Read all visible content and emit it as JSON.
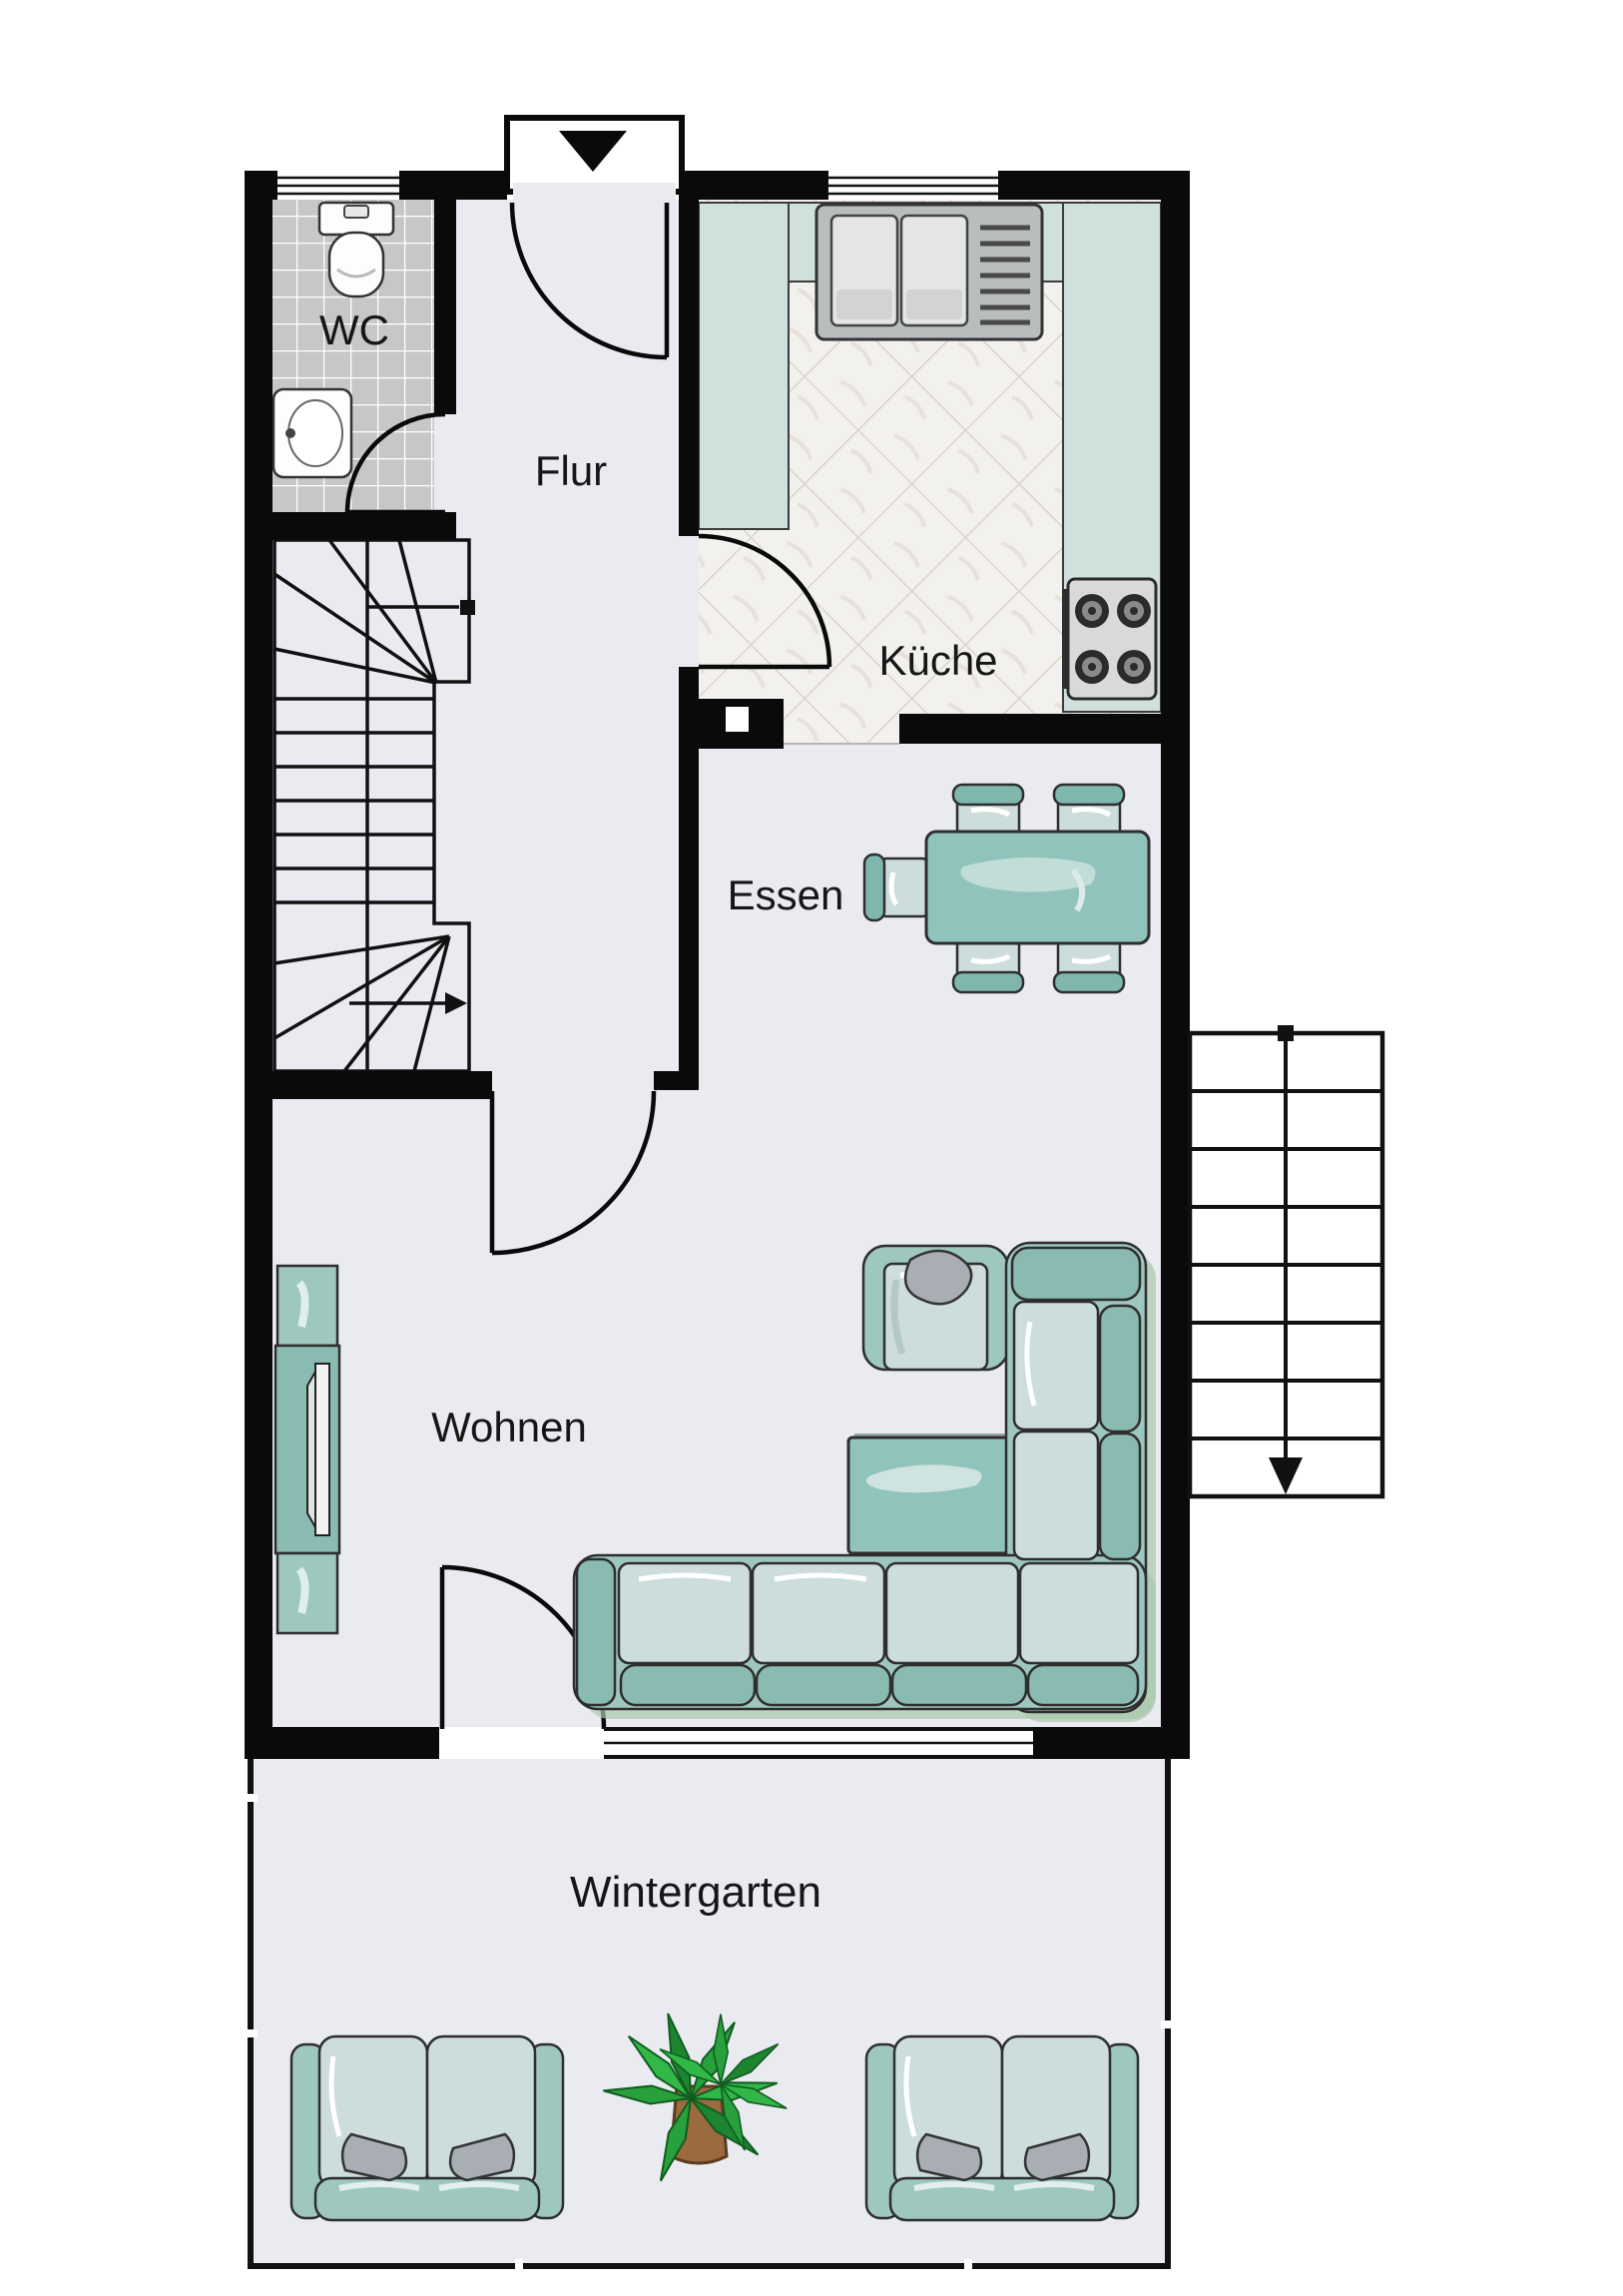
{
  "rooms": {
    "wc": {
      "label": "WC"
    },
    "flur": {
      "label": "Flur"
    },
    "kueche": {
      "label": "Küche"
    },
    "essen": {
      "label": "Essen"
    },
    "wohnen": {
      "label": "Wohnen"
    },
    "wintergarten": {
      "label": "Wintergarten"
    }
  },
  "icons": {
    "entrance_arrow": "entrance-arrow-icon",
    "toilet": "toilet-icon",
    "wash_basin": "wash-basin-icon",
    "kitchen_sink": "kitchen-sink-icon",
    "stove": "stove-icon",
    "chimney_flue": "chimney-flue-icon",
    "interior_staircase": "interior-staircase-icon",
    "exterior_staircase": "exterior-staircase-icon",
    "dining_table": "dining-table-icon",
    "chair": "chair-icon",
    "armchair": "armchair-icon",
    "coffee_table": "coffee-table-icon",
    "corner_sofa": "corner-sofa-icon",
    "sofa": "sofa-icon",
    "tv_sideboard": "tv-sideboard-icon",
    "flower_plant": "flower-plant-icon",
    "palm_plant": "palm-plant-icon"
  },
  "colors": {
    "wall": "#0a0a0a",
    "floor": "#e9ebf0",
    "wc_tile": "#c7c7c7",
    "kitchen_tile": "#f3f1ed",
    "kitchen_tile_line": "#d9d5ce",
    "counter": "#cfe0dd",
    "furniture_teal": "#9ec7c0",
    "furniture_teal_dark": "#8abbb3",
    "chair_back_teal": "#7fb7ae",
    "table_teal": "#8fc3bc",
    "seat_light": "#ccdddb",
    "pillow_gray": "#a9aeb5",
    "plant_green": "#28a03c",
    "pot_brown": "#9b6a3f",
    "sofa_shadow_green": "#aac7ab",
    "window_white": "#ffffff"
  }
}
